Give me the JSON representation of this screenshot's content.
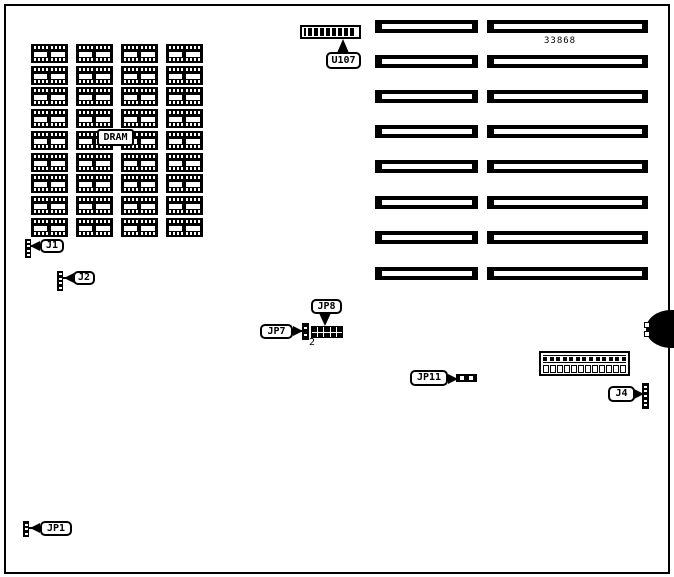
{
  "page": {
    "background": "#ffffff",
    "ink": "#000000"
  },
  "part_number": "33868",
  "labels": {
    "dram": "DRAM",
    "u107": "U107",
    "j1": "J1",
    "j2": "J2",
    "jp1": "JP1",
    "jp7": "JP7",
    "jp8": "JP8",
    "jp11": "JP11",
    "j4": "J4",
    "pin2": "2"
  },
  "components": {
    "dram_grid": {
      "rows": 9,
      "cols": 4,
      "pins_per_row": 8
    },
    "slot_grid": {
      "rows": 8,
      "columns": 2
    },
    "u107": {
      "pins": 8
    },
    "power_connector": {
      "top_pins": 13,
      "bottom_cells": 12
    },
    "headers": {
      "j1_ticks": 4,
      "j2_ticks": 4,
      "jp1_ticks": 3,
      "jp7_ticks": 2,
      "jp11_ticks": 2,
      "j4_ticks": 5,
      "jp8_grid": {
        "rows": 2,
        "cols": 5
      },
      "keyboard_pins": 2
    }
  }
}
